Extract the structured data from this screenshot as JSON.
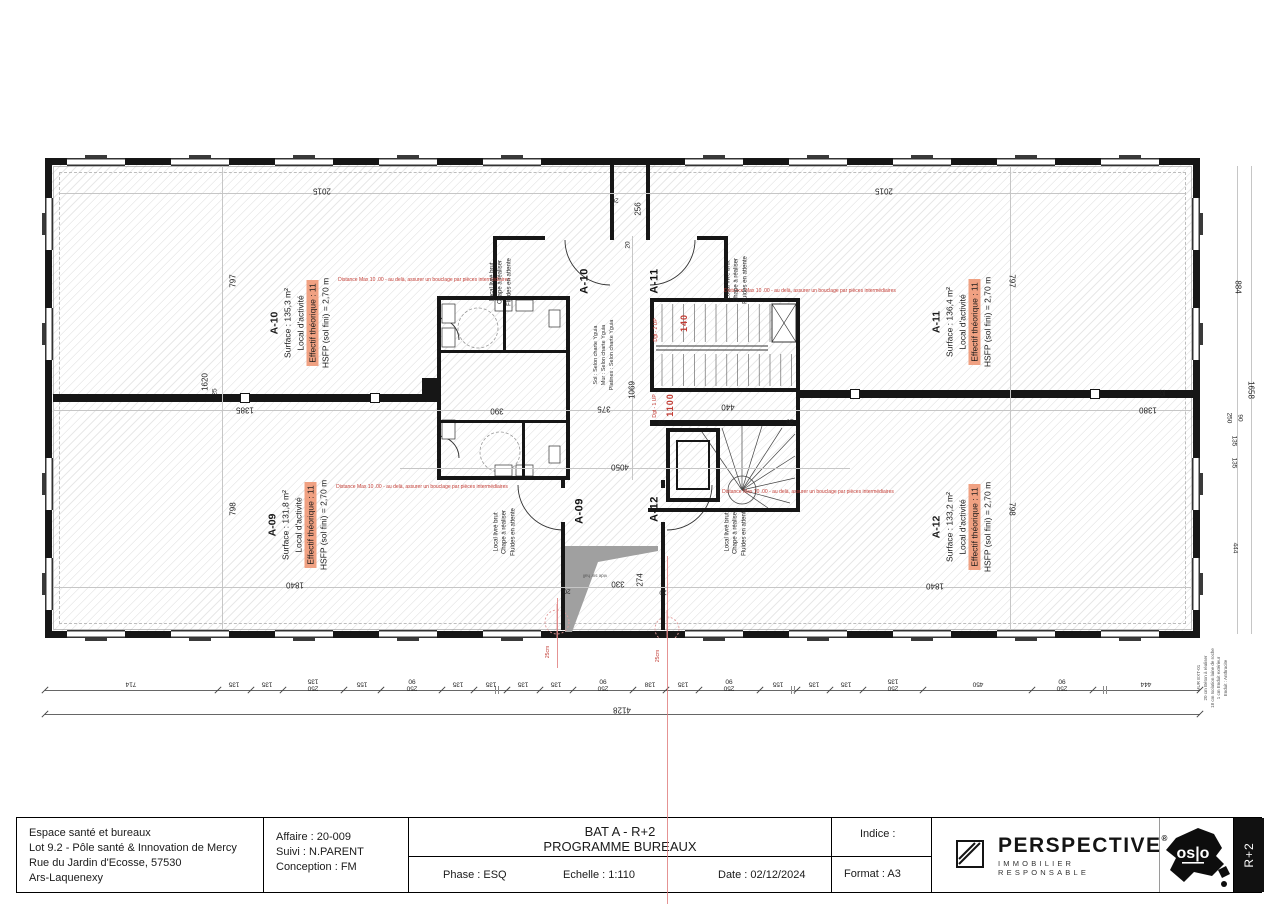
{
  "title_block": {
    "project_lines": [
      "Espace santé et bureaux",
      "Lot 9.2 - Pôle santé & Innovation de Mercy",
      "Rue du Jardin d'Ecosse, 57530",
      "Ars-Laquenexy"
    ],
    "affaire_lines": [
      "Affaire : 20-009",
      "Suivi : N.PARENT",
      "Conception : FM"
    ],
    "title_line1": "BAT A - R+2",
    "title_line2": "PROGRAMME BUREAUX",
    "phase": "Phase : ESQ",
    "echelle": "Echelle : 1:110",
    "date": "Date : 02/12/2024",
    "indice": "Indice :",
    "format": "Format : A3",
    "level_tag": "R+2"
  },
  "logos": {
    "perspective_name": "PERSPECTIVE",
    "perspective_reg": "®",
    "perspective_tagline": "IMMOBILIER RESPONSABLE",
    "oslo_text": "os|o"
  },
  "rooms": [
    {
      "id": "A-10",
      "surface": "Surface : 135,3 m²",
      "type": "Local d'activité",
      "effectif": "Effectif théorique : 11",
      "hsfp": "HSFP (sol fini) = 2,70 m",
      "cx": 300,
      "cy": 323
    },
    {
      "id": "A-11",
      "surface": "Surface : 136,4 m²",
      "type": "Local d'activité",
      "effectif": "Effectif théorique : 11",
      "hsfp": "HSFP (sol fini) = 2,70 m",
      "cx": 962,
      "cy": 322
    },
    {
      "id": "A-09",
      "surface": "Surface : 131,8 m²",
      "type": "Local d'activité",
      "effectif": "Effectif théorique : 11",
      "hsfp": "HSFP (sol fini) = 2,70 m",
      "cx": 298,
      "cy": 525
    },
    {
      "id": "A-12",
      "surface": "Surface : 133,2 m²",
      "type": "Local d'activité",
      "effectif": "Effectif théorique : 11",
      "hsfp": "HSFP (sol fini) = 2,70 m",
      "cx": 962,
      "cy": 527
    }
  ],
  "plan": {
    "labels": [
      {
        "t": "2015",
        "x": 322,
        "y": 191,
        "r": 180,
        "c": "dim"
      },
      {
        "t": "2015",
        "x": 884,
        "y": 191,
        "r": 180,
        "c": "dim"
      },
      {
        "t": "797",
        "x": 233,
        "y": 281,
        "r": -90,
        "c": "dim"
      },
      {
        "t": "797",
        "x": 1012,
        "y": 281,
        "r": 90,
        "c": "dim"
      },
      {
        "t": "798",
        "x": 233,
        "y": 509,
        "r": -90,
        "c": "dim"
      },
      {
        "t": "798",
        "x": 1012,
        "y": 509,
        "r": 90,
        "c": "dim"
      },
      {
        "t": "1620",
        "x": 205,
        "y": 382,
        "r": -90,
        "c": "dim"
      },
      {
        "t": "1385",
        "x": 245,
        "y": 410,
        "r": 180,
        "c": "dim"
      },
      {
        "t": "1380",
        "x": 1148,
        "y": 410,
        "r": 180,
        "c": "dim"
      },
      {
        "t": "1840",
        "x": 295,
        "y": 585,
        "r": 180,
        "c": "dim"
      },
      {
        "t": "1840",
        "x": 935,
        "y": 586,
        "r": 180,
        "c": "dim"
      },
      {
        "t": "390",
        "x": 497,
        "y": 411,
        "r": 180,
        "c": "dim"
      },
      {
        "t": "375",
        "x": 604,
        "y": 409,
        "r": 180,
        "c": "dim"
      },
      {
        "t": "1069",
        "x": 632,
        "y": 390,
        "r": -90,
        "c": "dim"
      },
      {
        "t": "440",
        "x": 728,
        "y": 407,
        "r": 180,
        "c": "dim"
      },
      {
        "t": "4050",
        "x": 620,
        "y": 467,
        "r": 180,
        "c": "dim"
      },
      {
        "t": "330",
        "x": 618,
        "y": 584,
        "r": 180,
        "c": "dim"
      },
      {
        "t": "274",
        "x": 640,
        "y": 580,
        "r": -90,
        "c": "dim"
      },
      {
        "t": "256",
        "x": 638,
        "y": 209,
        "r": -90,
        "c": "dim"
      },
      {
        "t": "884",
        "x": 1238,
        "y": 287,
        "r": 90,
        "c": "dim"
      },
      {
        "t": "1658",
        "x": 1251,
        "y": 390,
        "r": 90,
        "c": "dim"
      },
      {
        "t": "135",
        "x": 1234,
        "y": 441,
        "r": 90,
        "c": "dim-sm"
      },
      {
        "t": "135",
        "x": 1234,
        "y": 463,
        "r": 90,
        "c": "dim-sm"
      },
      {
        "t": "444",
        "x": 1235,
        "y": 548,
        "r": 90,
        "c": "dim-sm"
      },
      {
        "t": "250",
        "x": 1229,
        "y": 418,
        "r": 90,
        "c": "dim-sm"
      },
      {
        "t": "90",
        "x": 1240,
        "y": 418,
        "r": 90,
        "c": "dim-sm"
      },
      {
        "t": "25",
        "x": 215,
        "y": 392,
        "r": -90,
        "c": "dim-sm"
      },
      {
        "t": "25",
        "x": 1162,
        "y": 393,
        "r": 90,
        "c": "dim-sm"
      },
      {
        "t": "20",
        "x": 615,
        "y": 200,
        "r": 180,
        "c": "dim-sm"
      },
      {
        "t": "20",
        "x": 628,
        "y": 245,
        "r": -90,
        "c": "dim-sm"
      },
      {
        "t": "20",
        "x": 662,
        "y": 422,
        "r": 180,
        "c": "dim-sm"
      },
      {
        "t": "20",
        "x": 790,
        "y": 421,
        "r": 180,
        "c": "dim-sm"
      },
      {
        "t": "20",
        "x": 567,
        "y": 591,
        "r": 180,
        "c": "dim-sm"
      },
      {
        "t": "20",
        "x": 663,
        "y": 592,
        "r": 180,
        "c": "dim-sm"
      },
      {
        "t": "140",
        "x": 684,
        "y": 323,
        "r": -90,
        "c": "red-dim",
        "n": "stair-dim-red"
      },
      {
        "t": "1100",
        "x": 670,
        "y": 405,
        "r": -90,
        "c": "red-dim",
        "n": "stair-dim-red"
      },
      {
        "t": "Dgt - 2 UP",
        "x": 657,
        "y": 330,
        "r": -90,
        "c": "red-sm",
        "n": "stair-note"
      },
      {
        "t": "Dgt - 1 UP",
        "x": 656,
        "y": 406,
        "r": -90,
        "c": "red-sm",
        "n": "stair-note"
      },
      {
        "t": "25cm",
        "x": 549,
        "y": 652,
        "r": -90,
        "c": "red-sm",
        "n": "detail-note"
      },
      {
        "t": "25cm",
        "x": 659,
        "y": 656,
        "r": -90,
        "c": "red-sm",
        "n": "detail-note"
      },
      {
        "t": "Distance Max 10 .00 - au delà, assurer un bouclage par pièces intermédiaires",
        "x": 424,
        "y": 281,
        "r": 0,
        "c": "red-note",
        "n": "distance-annotation"
      },
      {
        "t": "Distance Max 10 .00 - au delà, assurer un bouclage par pièces intermédiaires",
        "x": 810,
        "y": 292,
        "r": 0,
        "c": "red-note",
        "n": "distance-annotation"
      },
      {
        "t": "Distance Max 10 .00 - au delà, assurer un bouclage par pièces intermédiaires",
        "x": 422,
        "y": 488,
        "r": 0,
        "c": "red-note",
        "n": "distance-annotation"
      },
      {
        "t": "Distance Max 10 .00 - au delà, assurer un bouclage par pièces intermédiaires",
        "x": 808,
        "y": 493,
        "r": 0,
        "c": "red-note",
        "n": "distance-annotation"
      },
      {
        "t": "Local livré brut\nChape à réaliser\nFluides en attente",
        "x": 501,
        "y": 282,
        "r": -90,
        "c": "note6",
        "n": "room-delivery-note"
      },
      {
        "t": "Local livré brut\nChape à réaliser\nFluides en attente",
        "x": 737,
        "y": 280,
        "r": -90,
        "c": "note6",
        "n": "room-delivery-note"
      },
      {
        "t": "Local livré brut\nChape à réaliser\nFluides en attente",
        "x": 505,
        "y": 532,
        "r": -90,
        "c": "note6",
        "n": "room-delivery-note"
      },
      {
        "t": "Local livré brut\nChape à réaliser\nFluides en attente",
        "x": 736,
        "y": 532,
        "r": -90,
        "c": "note6",
        "n": "room-delivery-note"
      },
      {
        "t": "Sol : Selon charte Yguia\nMur : Selon charte Yguia\nPlatines : Selon charte Yguia",
        "x": 605,
        "y": 355,
        "r": -90,
        "c": "charte",
        "n": "hall-finish-note"
      },
      {
        "t": "A-10",
        "x": 585,
        "y": 281,
        "r": -90,
        "c": "door",
        "n": "door-label"
      },
      {
        "t": "A-11",
        "x": 655,
        "y": 281,
        "r": -90,
        "c": "door",
        "n": "door-label"
      },
      {
        "t": "A-09",
        "x": 580,
        "y": 511,
        "r": -90,
        "c": "door",
        "n": "door-label"
      },
      {
        "t": "A-12",
        "x": 655,
        "y": 509,
        "r": -90,
        "c": "door",
        "n": "door-label"
      },
      {
        "t": "vide sur hall",
        "x": 595,
        "y": 575,
        "r": 180,
        "c": "tinygray",
        "n": "void-label"
      },
      {
        "t": "MUR EXT-01\n20 cm  Béton à réaliser\n18 cm  Isolation laine de roche\n1 cm  Enduit extérieur\nEnduit : Anthracite",
        "x": 1213,
        "y": 678,
        "r": -90,
        "c": "tinygray",
        "n": "wall-type-note"
      }
    ],
    "bottom_chain": {
      "segments": [
        "714",
        "135",
        "135",
        "250|135",
        "155",
        "250|90",
        "135",
        "135",
        "135",
        "135",
        "250|90",
        "138",
        "135",
        "250|90",
        "155",
        "135",
        "135",
        "250|135",
        "450",
        "250|90",
        "444"
      ],
      "total": "4128"
    }
  }
}
